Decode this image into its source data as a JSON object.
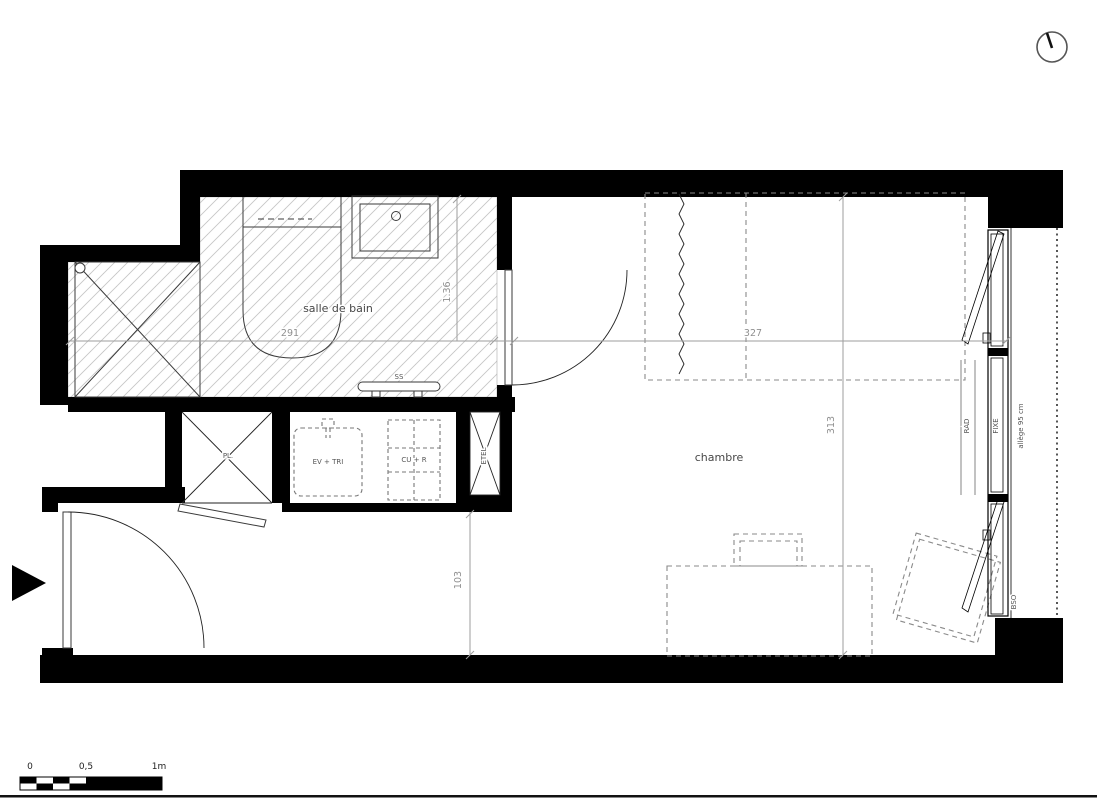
{
  "plan": {
    "north_symbol": "clock-north-indicator",
    "rooms": {
      "bathroom": "salle de bain",
      "bedroom": "chambre"
    },
    "labels": {
      "closet": "PL.",
      "sink_sorting": "EV + TRI",
      "cooking_fridge": "CU + R",
      "duct": "ETEL",
      "towel_dryer": "SS",
      "radiator": "RAD",
      "fixed_pane": "FIXE",
      "sill": "allège 95 cm",
      "blind": "BSO"
    },
    "dimensions": {
      "bathroom_width": "291",
      "bathroom_depth": "1.36",
      "bedroom_width": "327",
      "bedroom_depth": "313",
      "hall_depth": "103"
    },
    "scale_bar": {
      "zero": "0",
      "half": "0,5",
      "one": "1m"
    },
    "colors": {
      "wall": "#000000",
      "dimension": "#9e9e9e",
      "hatch": "#c6c6c6",
      "furniture_dash": "#8a8a8a"
    }
  }
}
